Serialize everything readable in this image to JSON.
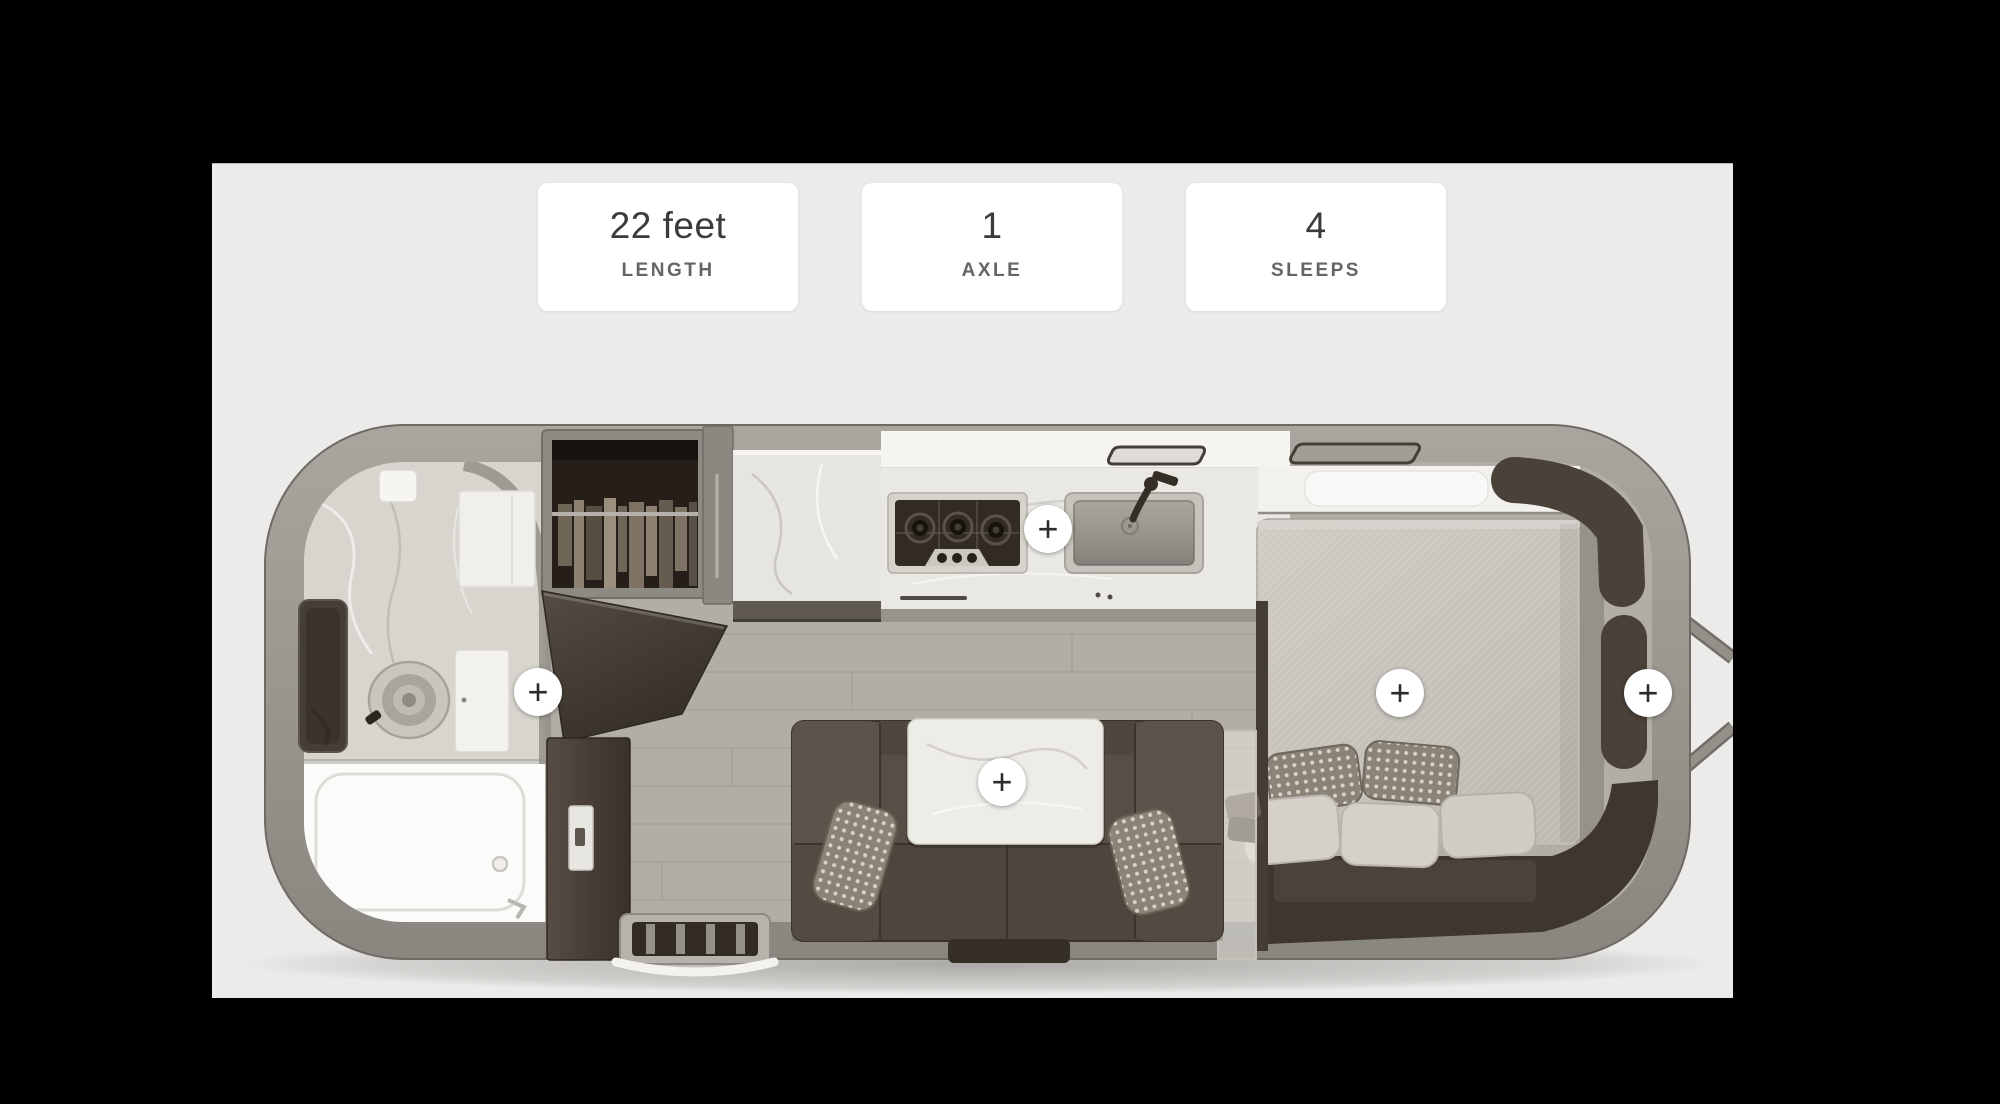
{
  "stats": {
    "cards": [
      {
        "id": "length",
        "value": "22 feet",
        "label": "LENGTH"
      },
      {
        "id": "axle",
        "value": "1",
        "label": "AXLE"
      },
      {
        "id": "sleeps",
        "value": "4",
        "label": "SLEEPS"
      }
    ]
  },
  "floorplan": {
    "plus_symbol": "+",
    "hotspots": [
      {
        "id": "bathroom"
      },
      {
        "id": "kitchen"
      },
      {
        "id": "lounge-table"
      },
      {
        "id": "bed"
      },
      {
        "id": "rear-storage"
      }
    ],
    "areas": [
      "bathroom",
      "shower",
      "wardrobe",
      "kitchen",
      "stove",
      "sink",
      "lounge-sofa",
      "table",
      "bedroom-bed",
      "rear-storage",
      "entry-door",
      "entry-step",
      "hitch"
    ]
  },
  "colors": {
    "backdrop": "#000000",
    "panel": "#ecebe9",
    "card": "#ffffff",
    "stat_value": "#3d3b39",
    "stat_label": "#676562",
    "shell_gray": "#98948e",
    "floor_gray": "#b2aea7",
    "dark_wood": "#453d34",
    "marble": "#e8e6e1",
    "hotspot_plus": "#2d2a27"
  }
}
